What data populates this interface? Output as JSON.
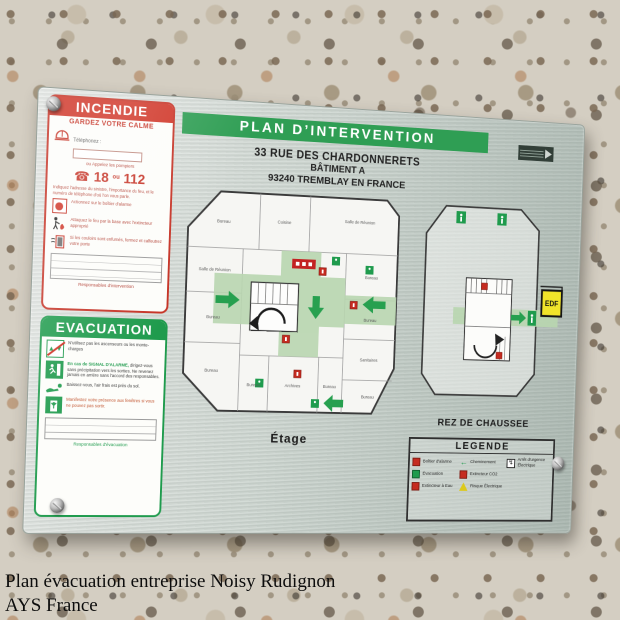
{
  "sign": {
    "title": "PLAN D’INTERVENTION",
    "address": [
      "33 RUE DES CHARDONNERETS",
      "BÂTIMENT A",
      "93240 TREMBLAY EN FRANCE"
    ],
    "incendie": {
      "header": "INCENDIE",
      "calm": "GARDEZ VOTRE CALME",
      "phone_label": "Téléphonez :",
      "call_hint": "ou Appelez les pompiers",
      "num1": "18",
      "num_sep": "ou",
      "num2": "112",
      "notice": "Indiquez l'adresse du sinistre, l'importance du feu, et le numéro de téléphone d'où l'on vous parle.",
      "step1": "Actionnez sur le boîtier d'alarme",
      "step2": "Attaquez le feu par la base avec l'extincteur approprié",
      "step3": "Si les couloirs sont enfumés, fermez et calfeutrez votre porte",
      "footer": "Responsables d'intervention"
    },
    "evacuation": {
      "header": "EVACUATION",
      "row1": "N'utilisez pas les ascenseurs ou les monte-charges",
      "row2_highlight": "En cas de SIGNAL D'ALARME,",
      "row2_text": "dirigez-vous sans précipitation vers les sorties. Ne revenez jamais en arrière sans l'accord des responsables.",
      "row3": "Baissez-vous, l'air frais est près du sol.",
      "row4": "Manifestez votre présence aux fenêtres si vous ne pouvez pas sortir.",
      "footer": "Responsables d'évacuation"
    },
    "etage": {
      "label": "Étage",
      "rooms": [
        "Bureau",
        "Cuisine",
        "Salle de Réunion",
        "Salle de Réunion",
        "Bureau",
        "Bureau",
        "Bureau",
        "Bureau",
        "Sanitaires",
        "Bureau",
        "Bureau",
        "Archives",
        "Bureau"
      ]
    },
    "rdc": {
      "label": "REZ DE CHAUSSEE",
      "edf_label": "EDF"
    },
    "legende": {
      "title": "LEGENDE",
      "items": [
        {
          "icon": "alarm-box-icon",
          "label": "Boîtier d'alarme"
        },
        {
          "icon": "evacuation-icon",
          "label": "Évacuation"
        },
        {
          "icon": "water-extinguisher-icon",
          "label": "Extincteur à Eau"
        },
        {
          "icon": "route-arrow-icon",
          "label": "Cheminement"
        },
        {
          "icon": "co2-extinguisher-icon",
          "label": "Extincteur CO2"
        },
        {
          "icon": "electrical-hazard-icon",
          "label": "Risque Électrique"
        },
        {
          "icon": "emergency-stop-icon",
          "label": "Arrêt d'urgence Électrique"
        }
      ]
    }
  },
  "icons": {
    "phone_glyph": "☎",
    "route_arrow": "←",
    "hazard_bolt": "↯",
    "elevator_up": "▲",
    "elevator_down": "▼"
  },
  "caption": {
    "line1": "Plan évacuation entreprise Noisy Rudignon",
    "line2": "AYS France"
  },
  "colors": {
    "sign_green": "#2f9e54",
    "alert_red": "#c63326",
    "corridor_green": "#b9d6b0",
    "edf_yellow": "#f0e42a"
  }
}
